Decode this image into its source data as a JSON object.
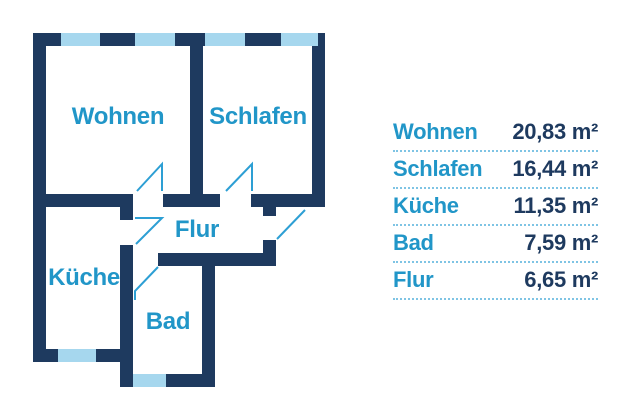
{
  "floorplan": {
    "rooms": [
      {
        "label": "Wohnen"
      },
      {
        "label": "Schlafen"
      },
      {
        "label": "Flur"
      },
      {
        "label": "Küche"
      },
      {
        "label": "Bad"
      }
    ]
  },
  "legend": {
    "rows": [
      {
        "name": "Wohnen",
        "area": "20,83 m²"
      },
      {
        "name": "Schlafen",
        "area": "16,44 m²"
      },
      {
        "name": "Küche",
        "area": "11,35 m²"
      },
      {
        "name": "Bad",
        "area": "7,59 m²"
      },
      {
        "name": "Flur",
        "area": "6,65 m²"
      }
    ]
  },
  "colors": {
    "wall": "#1e3a5f",
    "room_label": "#2196c8",
    "window": "#a6d7ee",
    "door": "#2d9fd4",
    "separator": "#7fc4e4"
  },
  "icons": [
    {
      "name": "door-swing-icon",
      "meaning": "door opening direction marker"
    },
    {
      "name": "window-marker",
      "meaning": "window segment in wall"
    }
  ]
}
